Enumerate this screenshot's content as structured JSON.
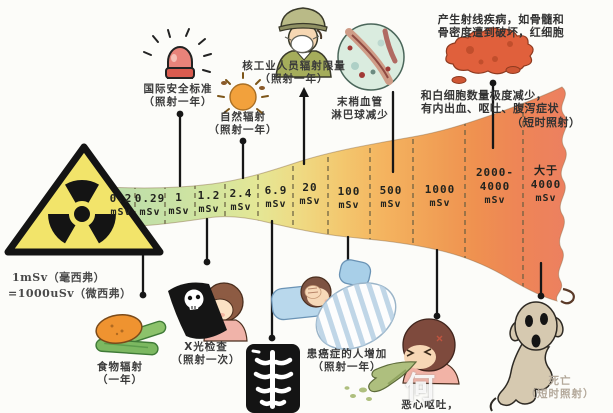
{
  "unit_note": {
    "line1": "1mSv（毫西弗）",
    "line2": "=1000uSv（微西弗）"
  },
  "funnel": {
    "unit": "mSv",
    "segments": [
      {
        "lines": [
          "0.2"
        ]
      },
      {
        "lines": [
          "0.29"
        ]
      },
      {
        "lines": [
          "1"
        ]
      },
      {
        "lines": [
          "1.2"
        ]
      },
      {
        "lines": [
          "2.4"
        ]
      },
      {
        "lines": [
          "6.9"
        ]
      },
      {
        "lines": [
          "20"
        ]
      },
      {
        "lines": [
          "100"
        ]
      },
      {
        "lines": [
          "500"
        ]
      },
      {
        "lines": [
          "1000"
        ]
      },
      {
        "lines": [
          "2000-",
          "4000"
        ]
      },
      {
        "lines": [
          "大于",
          "4000"
        ]
      }
    ],
    "colors": {
      "low": "#b9dcab",
      "mid": "#efda83",
      "high": "#ec7f62"
    }
  },
  "annotations": {
    "intl_standard": {
      "line1": "国际安全标准",
      "line2": "（照射一年）"
    },
    "natural": {
      "line1": "自然辐射",
      "line2": "（照射一年）"
    },
    "nuclear_worker": {
      "line1": "核工业人员辐射限量",
      "line2": "（照射一年）"
    },
    "blood_vessels": {
      "line1": "末梢血管",
      "line2": "淋巴球减少"
    },
    "radiation_disease": {
      "line1": "产生射线疾病，如骨髓和",
      "line2": "骨密度遭到破坏，红细胞",
      "line3": "和白细胞数量极度减少，",
      "line4": "有内出血、呕吐、腹泻症状",
      "line5": "（短时照射）"
    },
    "food": {
      "line1": "食物辐射",
      "line2": "（一年）"
    },
    "xray": {
      "line1": "X光检查",
      "line2": "（照射一次）"
    },
    "cancer": {
      "line1": "患癌症的人增加",
      "line2": "（照射一年）"
    },
    "nausea": {
      "line1": "恶心呕吐，"
    },
    "death": {
      "line1": "死亡",
      "line2": "（短时照射）"
    }
  },
  "watermark": "何",
  "icons": {
    "radiation_warning": "radiation-trefoil",
    "siren": "alarm-siren",
    "sun": "sun",
    "worker": "masked-nuclear-worker",
    "blood_cells": "blood-cells-circle",
    "bone_marrow": "bone-marrow-blob",
    "food": "potato-and-cucumbers",
    "xray_child": "child-with-xray-film",
    "chest_xray": "chest-xray-film",
    "patient_bed": "patient-in-bed",
    "vomiting": "vomiting-person",
    "ghost": "death-ghost"
  }
}
